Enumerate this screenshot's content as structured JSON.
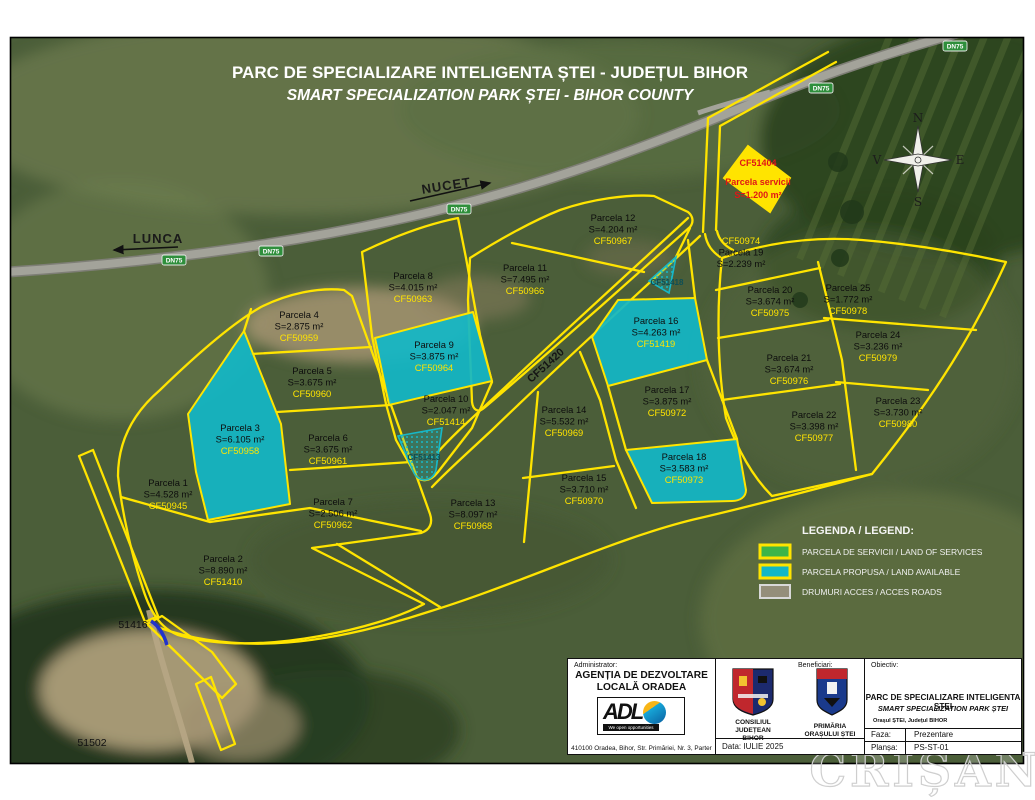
{
  "title": {
    "line1": "PARC DE SPECIALIZARE INTELIGENTA ȘTEI - JUDEȚUL BIHOR",
    "line2": "SMART SPECIALIZATION PARK ȘTEI - BIHOR COUNTY"
  },
  "compass": {
    "north": "N",
    "south": "S",
    "east": "E",
    "west": "V"
  },
  "roads": {
    "badge": "DN75",
    "direction_right": "NUCET",
    "direction_left": "LUNCA",
    "access_road_label": "CF51420"
  },
  "references": {
    "ref_51416": "51416",
    "ref_51502": "51502"
  },
  "service_parcel": {
    "cf": "CF51404",
    "name": "Parcela servicii",
    "area": "S=1.200 m²"
  },
  "hatched_parcels": {
    "first": "CF51413",
    "second": "CF51418"
  },
  "parcels": [
    {
      "id": 1,
      "name": "Parcela 1",
      "area": "S=4.528 m²",
      "cf": "CF50945",
      "type": "standard"
    },
    {
      "id": 2,
      "name": "Parcela 2",
      "area": "S=8.890 m²",
      "cf": "CF51410",
      "type": "standard"
    },
    {
      "id": 3,
      "name": "Parcela 3",
      "area": "S=6.105 m²",
      "cf": "CF50958",
      "type": "available"
    },
    {
      "id": 4,
      "name": "Parcela 4",
      "area": "S=2.875 m²",
      "cf": "CF50959",
      "type": "standard"
    },
    {
      "id": 5,
      "name": "Parcela 5",
      "area": "S=3.675 m²",
      "cf": "CF50960",
      "type": "standard"
    },
    {
      "id": 6,
      "name": "Parcela 6",
      "area": "S=3.675 m²",
      "cf": "CF50961",
      "type": "standard"
    },
    {
      "id": 7,
      "name": "Parcela 7",
      "area": "S=2.506 m²",
      "cf": "CF50962",
      "type": "standard"
    },
    {
      "id": 8,
      "name": "Parcela 8",
      "area": "S=4.015 m²",
      "cf": "CF50963",
      "type": "standard"
    },
    {
      "id": 9,
      "name": "Parcela 9",
      "area": "S=3.875 m²",
      "cf": "CF50964",
      "type": "available"
    },
    {
      "id": 10,
      "name": "Parcela 10",
      "area": "S=2.047 m²",
      "cf": "CF51414",
      "type": "standard"
    },
    {
      "id": 11,
      "name": "Parcela 11",
      "area": "S=7.495 m²",
      "cf": "CF50966",
      "type": "standard"
    },
    {
      "id": 12,
      "name": "Parcela 12",
      "area": "S=4.204 m²",
      "cf": "CF50967",
      "type": "standard"
    },
    {
      "id": 13,
      "name": "Parcela 13",
      "area": "S=8.097 m²",
      "cf": "CF50968",
      "type": "standard"
    },
    {
      "id": 14,
      "name": "Parcela 14",
      "area": "S=5.532 m²",
      "cf": "CF50969",
      "type": "standard"
    },
    {
      "id": 15,
      "name": "Parcela 15",
      "area": "S=3.710 m²",
      "cf": "CF50970",
      "type": "standard"
    },
    {
      "id": 16,
      "name": "Parcela 16",
      "area": "S=4.263 m²",
      "cf": "CF51419",
      "type": "available"
    },
    {
      "id": 17,
      "name": "Parcela 17",
      "area": "S=3.875 m²",
      "cf": "CF50972",
      "type": "standard"
    },
    {
      "id": 18,
      "name": "Parcela 18",
      "area": "S=3.583 m²",
      "cf": "CF50973",
      "type": "available"
    },
    {
      "id": 19,
      "name": "Parcela 19",
      "area": "S=2.239 m²",
      "cf": "CF50974",
      "type": "standard"
    },
    {
      "id": 20,
      "name": "Parcela 20",
      "area": "S=3.674 m²",
      "cf": "CF50975",
      "type": "standard"
    },
    {
      "id": 21,
      "name": "Parcela 21",
      "area": "S=3.674 m²",
      "cf": "CF50976",
      "type": "standard"
    },
    {
      "id": 22,
      "name": "Parcela 22",
      "area": "S=3.398 m²",
      "cf": "CF50977",
      "type": "standard"
    },
    {
      "id": 23,
      "name": "Parcela 23",
      "area": "S=3.730 m²",
      "cf": "CF50980",
      "type": "standard"
    },
    {
      "id": 24,
      "name": "Parcela 24",
      "area": "S=3.236 m²",
      "cf": "CF50979",
      "type": "standard"
    },
    {
      "id": 25,
      "name": "Parcela 25",
      "area": "S=1.772 m²",
      "cf": "CF50978",
      "type": "standard"
    }
  ],
  "legend": {
    "title": "LEGENDA / LEGEND:",
    "items": [
      {
        "label": "PARCELA DE SERVICII / LAND OF SERVICES",
        "color": "#3cb549"
      },
      {
        "label": "PARCELA PROPUSA / LAND AVAILABLE",
        "color": "#12b7c7"
      },
      {
        "label": "DRUMURI ACCES / ACCES ROADS",
        "color": "#948e7a"
      }
    ]
  },
  "info_box": {
    "administrator_label": "Administrator:",
    "administrator_name_1": "AGENȚIA DE DEZVOLTARE",
    "administrator_name_2": "LOCALĂ ORADEA",
    "logo_text": "ADL",
    "logo_tagline": "We open opportunities",
    "address": "410100 Oradea, Bihor, Str. Primăriei, Nr. 3, Parter",
    "beneficiary_label": "Beneficiari:",
    "beneficiary_1_line1": "CONSILIUL",
    "beneficiary_1_line2": "JUDEȚEAN",
    "beneficiary_1_line3": "BIHOR",
    "beneficiary_2_line1": "PRIMĂRIA",
    "beneficiary_2_line2": "ORAȘULUI ȘTEI",
    "objective_label": "Obiectiv:",
    "objective_1": "PARC DE SPECIALIZARE INTELIGENTA ȘTEI",
    "objective_2": "SMART SPECIALIZATION PARK ȘTEI",
    "location": "Orașul ȘTEI, Județul BIHOR",
    "data_label": "Data:",
    "data_value": "IULIE 2025",
    "faza_label": "Faza:",
    "faza_value": "Prezentare",
    "plansa_label": "Planșa:",
    "plansa_value": "PS-ST-01"
  },
  "watermark": "CRIȘANA"
}
